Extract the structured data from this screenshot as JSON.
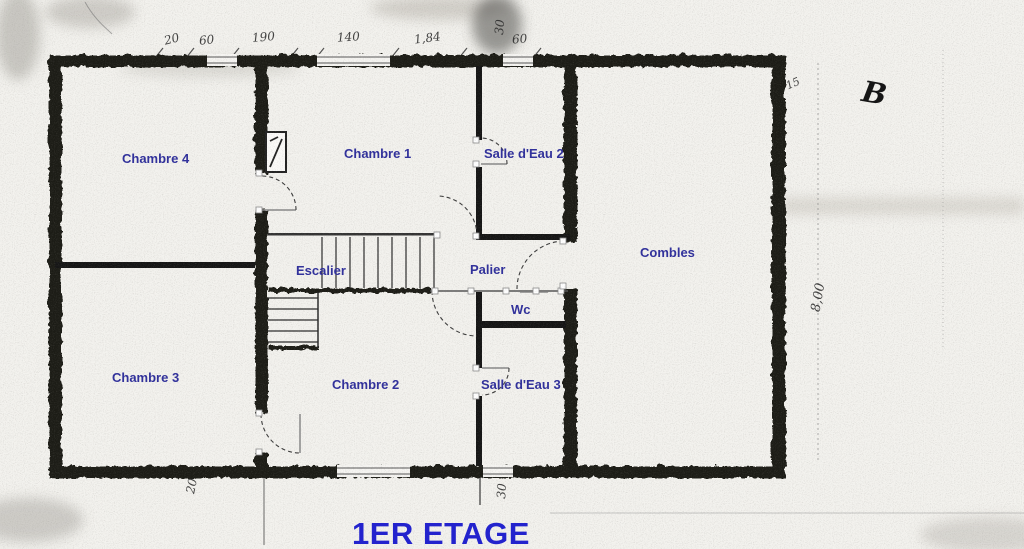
{
  "title": "1ER ETAGE",
  "rooms": {
    "chambre4": "Chambre 4",
    "chambre1": "Chambre 1",
    "salle_eau2": "Salle d'Eau 2",
    "combles": "Combles",
    "escalier": "Escalier",
    "palier": "Palier",
    "wc": "Wc",
    "chambre3": "Chambre 3",
    "chambre2": "Chambre 2",
    "salle_eau3": "Salle d'Eau 3"
  },
  "annotations": {
    "top_dims": [
      "20",
      "60",
      "190",
      "140",
      "1,84",
      "30",
      "60"
    ],
    "bottom_left_dim": "20",
    "bottom_mid_dim": "30",
    "right_height_dim": "8,00",
    "right_wall_dim": "15",
    "letter_mark": "B"
  },
  "colors": {
    "room_label_blue": "#32329b",
    "title_blue": "#2323cd",
    "wall_ink": "#1a1a18",
    "paper": "#f3f2ee"
  }
}
